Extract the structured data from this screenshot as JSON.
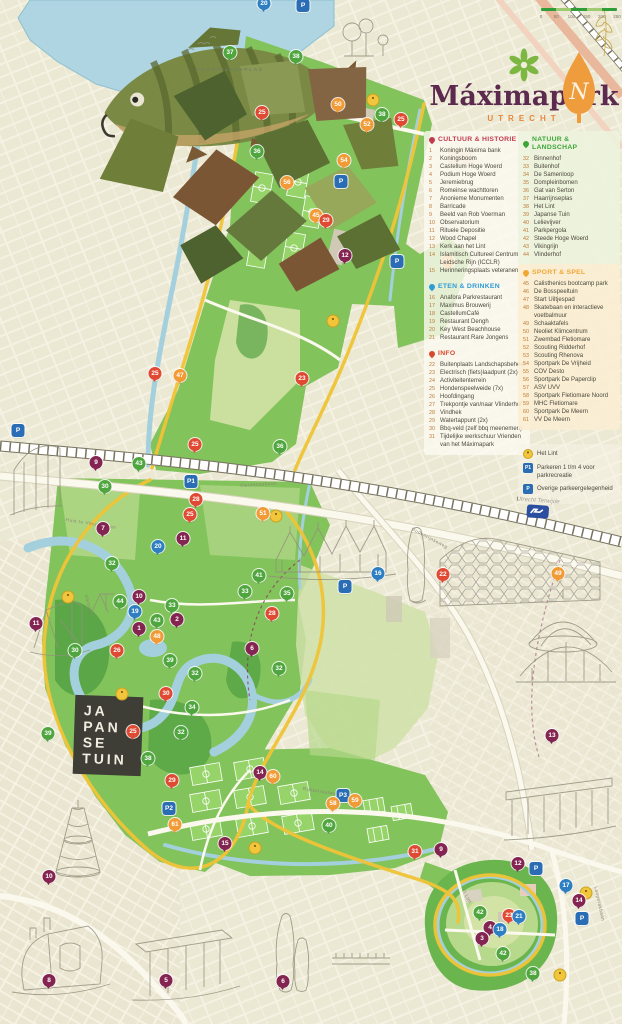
{
  "title": {
    "name": "Máximapark",
    "city": "UTRECHT"
  },
  "compass": {
    "letter": "N"
  },
  "scale_bar": {
    "ticks": [
      "0",
      "50",
      "100",
      "150",
      "200",
      "250"
    ]
  },
  "map_labels": {
    "lake": "HAARRIJNSEPLAS",
    "japanse_tuin": [
      "JA",
      "PAN",
      "SE",
      "TUIN"
    ],
    "station": "Utrecht Terwijde",
    "streets": [
      {
        "label": "Vleutensebaan",
        "x": 240,
        "y": 483,
        "r": -4
      },
      {
        "label": "Oudenrijnseweg",
        "x": 412,
        "y": 526,
        "r": 28
      },
      {
        "label": "Huis te Vleutenbaan",
        "x": 66,
        "y": 517,
        "r": 9
      },
      {
        "label": "Rijksstraatweg",
        "x": 303,
        "y": 786,
        "r": 9
      },
      {
        "label": "Langerakbaan",
        "x": 596,
        "y": 884,
        "r": 78
      },
      {
        "label": "Vikingrijn",
        "x": 86,
        "y": 592,
        "r": 75
      },
      {
        "label": "'t Lint",
        "x": 464,
        "y": 888,
        "r": 62
      }
    ]
  },
  "legend": {
    "sections": [
      {
        "id": "cultuur",
        "label": "CULTUUR & HISTORIE",
        "color": "#c23a4e",
        "items": [
          {
            "n": 1,
            "label": "Koningin Máxima bank"
          },
          {
            "n": 2,
            "label": "Koningsboom"
          },
          {
            "n": 3,
            "label": "Castellum Hoge Woerd"
          },
          {
            "n": 4,
            "label": "Podium Hoge Woerd"
          },
          {
            "n": 5,
            "label": "Jeremiebrug"
          },
          {
            "n": 6,
            "label": "Romeinse wachttoren"
          },
          {
            "n": 7,
            "label": "Anonieme Monumenten"
          },
          {
            "n": 8,
            "label": "Barricade"
          },
          {
            "n": 9,
            "label": "Beeld van Rob Voerman"
          },
          {
            "n": 10,
            "label": "Observatorium"
          },
          {
            "n": 11,
            "label": "Rituele Depositie"
          },
          {
            "n": 12,
            "label": "Wood Chapel"
          },
          {
            "n": 13,
            "label": "Kerk aan het Lint"
          },
          {
            "n": 14,
            "label": "Islamitisch Cultureel Centrum Leidsche Rijn (ICCLR)"
          },
          {
            "n": 15,
            "label": "Herinneringsplaats veteranen"
          }
        ]
      },
      {
        "id": "eten",
        "label": "ETEN & DRINKEN",
        "color": "#2e9bd6",
        "items": [
          {
            "n": 16,
            "label": "Anafora Parkrestaurant"
          },
          {
            "n": 17,
            "label": "Maximus Brouwerij"
          },
          {
            "n": 18,
            "label": "CastellumCafé"
          },
          {
            "n": 19,
            "label": "Restaurant Dengh"
          },
          {
            "n": 20,
            "label": "Key West Beachhouse"
          },
          {
            "n": 21,
            "label": "Restaurant Rare Jongens"
          }
        ]
      },
      {
        "id": "info",
        "label": "INFO",
        "color": "#d9472f",
        "items": [
          {
            "n": 22,
            "label": "Buitenplaats Landschapsbeheer"
          },
          {
            "n": 23,
            "label": "Electrisch (fiets)laadpunt (2x)"
          },
          {
            "n": 24,
            "label": "Activiteitenterrein"
          },
          {
            "n": 25,
            "label": "Hondenspeelweide (7x)"
          },
          {
            "n": 26,
            "label": "Hoofdingang"
          },
          {
            "n": 27,
            "label": "Trekpontje van/naar Vlinderhof"
          },
          {
            "n": 28,
            "label": "Vindhek"
          },
          {
            "n": 29,
            "label": "Watertappunt (2x)"
          },
          {
            "n": 30,
            "label": "Bbq-veld (zelf bbq meenemen)"
          },
          {
            "n": 31,
            "label": "Tijdelijke werkschuur Vrienden van het Máximapark"
          }
        ]
      },
      {
        "id": "natuur",
        "label": "NATUUR & LANDSCHAP",
        "color": "#3da639",
        "items": [
          {
            "n": 32,
            "label": "Binnenhof"
          },
          {
            "n": 33,
            "label": "Buitenhof"
          },
          {
            "n": 34,
            "label": "De Samenloop"
          },
          {
            "n": 35,
            "label": "Dompleinbomen"
          },
          {
            "n": 36,
            "label": "Gat van Serton"
          },
          {
            "n": 37,
            "label": "Haarrijnseplas"
          },
          {
            "n": 38,
            "label": "Het Lint"
          },
          {
            "n": 39,
            "label": "Japanse Tuin"
          },
          {
            "n": 40,
            "label": "Lelievijver"
          },
          {
            "n": 41,
            "label": "Parkpergola"
          },
          {
            "n": 42,
            "label": "Steede Hoge Woerd"
          },
          {
            "n": 43,
            "label": "Vikingrijn"
          },
          {
            "n": 44,
            "label": "Vlinderhof"
          }
        ]
      },
      {
        "id": "sport",
        "label": "SPORT & SPEL",
        "color": "#f2a632",
        "items": [
          {
            "n": 45,
            "label": "Calisthenics bootcamp park"
          },
          {
            "n": 46,
            "label": "De Bosspeeltuin"
          },
          {
            "n": 47,
            "label": "Start Uiltjespad"
          },
          {
            "n": 48,
            "label": "Skatebaan en interactieve voetbalmuur"
          },
          {
            "n": 49,
            "label": "Schaaktafels"
          },
          {
            "n": 50,
            "label": "Neoliet Klimcentrum"
          },
          {
            "n": 51,
            "label": "Zwembad Fletiomare"
          },
          {
            "n": 52,
            "label": "Scouting Ridderhof"
          },
          {
            "n": 53,
            "label": "Scouting Rhenova"
          },
          {
            "n": 54,
            "label": "Sportpark De Vrijheid"
          },
          {
            "n": 55,
            "label": "COV Desto"
          },
          {
            "n": 56,
            "label": "Sportpark De Paperclip"
          },
          {
            "n": 57,
            "label": "ASV UVV"
          },
          {
            "n": 58,
            "label": "Sportpark Fletiomare Noord"
          },
          {
            "n": 59,
            "label": "MHC Fletiomare"
          },
          {
            "n": 60,
            "label": "Sportpark De Meern"
          },
          {
            "n": 61,
            "label": "VV De Meern"
          }
        ]
      }
    ]
  },
  "footer_legend": {
    "items": [
      {
        "icon": "lint-lamp-icon",
        "label": "Het Lint"
      },
      {
        "icon": "parking-1-icon",
        "label": "Parkeren 1 t/m 4 voor parkrecreatie"
      },
      {
        "icon": "parking-icon",
        "label": "Overige parkeergelegenheid"
      }
    ]
  },
  "marker_colors": {
    "cultuur": "#832550",
    "eten": "#2e7fc1",
    "info": "#e04a33",
    "natuur": "#4fa53e",
    "sport": "#f29b36",
    "lint": "#f1c63c",
    "parking": "#2a6db5"
  },
  "theme": {
    "paper": "#efecd9",
    "park_green": "#83c35c",
    "water": "#aed5e1",
    "lint_yellow": "#f0c437",
    "title_maroon": "#5c2a4e",
    "accent_orange": "#e8873c"
  },
  "markers": [
    [
      "20",
      "e",
      264,
      10
    ],
    [
      "P",
      "P",
      303,
      12
    ],
    [
      "37",
      "n",
      230,
      59
    ],
    [
      "38",
      "n",
      296,
      63
    ],
    [
      "25",
      "i",
      262,
      119
    ],
    [
      "50",
      "s",
      338,
      111
    ],
    [
      "",
      "L",
      373,
      100
    ],
    [
      "38",
      "n",
      382,
      121
    ],
    [
      "25",
      "i",
      401,
      126
    ],
    [
      "52",
      "s",
      367,
      131
    ],
    [
      "36",
      "n",
      257,
      158
    ],
    [
      "54",
      "s",
      344,
      167
    ],
    [
      "56",
      "s",
      287,
      189
    ],
    [
      "P",
      "P",
      341,
      188
    ],
    [
      "45",
      "s",
      316,
      222
    ],
    [
      "29",
      "i",
      326,
      227
    ],
    [
      "53",
      "s",
      448,
      268
    ],
    [
      "12",
      "c",
      345,
      262
    ],
    [
      "P",
      "P",
      397,
      268
    ],
    [
      "",
      "L",
      333,
      321
    ],
    [
      "23",
      "i",
      302,
      385
    ],
    [
      "47",
      "s",
      180,
      382
    ],
    [
      "25",
      "i",
      155,
      380
    ],
    [
      "P",
      "P",
      18,
      437
    ],
    [
      "25",
      "i",
      195,
      451
    ],
    [
      "9",
      "c",
      96,
      469
    ],
    [
      "43",
      "n",
      139,
      470
    ],
    [
      "36",
      "n",
      280,
      453
    ],
    [
      "30",
      "n",
      105,
      493
    ],
    [
      "P1",
      "P",
      191,
      488
    ],
    [
      "28",
      "i",
      196,
      506
    ],
    [
      "25",
      "i",
      190,
      521
    ],
    [
      "7",
      "c",
      103,
      535
    ],
    [
      "",
      "L",
      276,
      516
    ],
    [
      "51",
      "s",
      263,
      520
    ],
    [
      "16",
      "e",
      378,
      580
    ],
    [
      "P",
      "P",
      345,
      593
    ],
    [
      "22",
      "i",
      443,
      581
    ],
    [
      "49",
      "s",
      558,
      580
    ],
    [
      "11",
      "c",
      183,
      545
    ],
    [
      "20",
      "e",
      158,
      553
    ],
    [
      "32",
      "n",
      112,
      570
    ],
    [
      "",
      "L",
      68,
      597
    ],
    [
      "44",
      "n",
      120,
      608
    ],
    [
      "10",
      "c",
      139,
      603
    ],
    [
      "19",
      "e",
      135,
      618
    ],
    [
      "33",
      "n",
      172,
      612
    ],
    [
      "2",
      "c",
      177,
      626
    ],
    [
      "43",
      "n",
      157,
      627
    ],
    [
      "1",
      "c",
      139,
      635
    ],
    [
      "48",
      "s",
      157,
      643
    ],
    [
      "26",
      "i",
      117,
      657
    ],
    [
      "30",
      "n",
      75,
      657
    ],
    [
      "39",
      "n",
      170,
      667
    ],
    [
      "32",
      "n",
      195,
      680
    ],
    [
      "41",
      "n",
      259,
      582
    ],
    [
      "33",
      "n",
      245,
      598
    ],
    [
      "35",
      "n",
      287,
      600
    ],
    [
      "28",
      "i",
      272,
      620
    ],
    [
      "6",
      "c",
      252,
      655
    ],
    [
      "32",
      "n",
      279,
      675
    ],
    [
      "13",
      "c",
      552,
      742
    ],
    [
      "39",
      "n",
      48,
      740
    ],
    [
      "",
      "L",
      122,
      694
    ],
    [
      "30",
      "i",
      166,
      700
    ],
    [
      "34",
      "n",
      192,
      714
    ],
    [
      "25",
      "i",
      133,
      738
    ],
    [
      "32",
      "n",
      181,
      739
    ],
    [
      "38",
      "n",
      148,
      765
    ],
    [
      "29",
      "i",
      172,
      787
    ],
    [
      "P2",
      "P",
      169,
      815
    ],
    [
      "61",
      "s",
      175,
      831
    ],
    [
      "15",
      "c",
      225,
      850
    ],
    [
      "",
      "L",
      255,
      848
    ],
    [
      "14",
      "c",
      260,
      779
    ],
    [
      "60",
      "s",
      273,
      783
    ],
    [
      "P3",
      "P",
      343,
      802
    ],
    [
      "58",
      "s",
      333,
      810
    ],
    [
      "59",
      "s",
      355,
      807
    ],
    [
      "40",
      "n",
      329,
      832
    ],
    [
      "31",
      "i",
      415,
      858
    ],
    [
      "9",
      "c",
      441,
      856
    ],
    [
      "12",
      "c",
      518,
      870
    ],
    [
      "P",
      "P",
      536,
      875
    ],
    [
      "17",
      "e",
      566,
      892
    ],
    [
      "",
      "L",
      586,
      893
    ],
    [
      "14",
      "c",
      579,
      907
    ],
    [
      "P",
      "P",
      582,
      925
    ],
    [
      "42",
      "n",
      480,
      919
    ],
    [
      "23",
      "i",
      509,
      922
    ],
    [
      "21",
      "e",
      519,
      923
    ],
    [
      "4",
      "c",
      490,
      934
    ],
    [
      "18",
      "e",
      500,
      936
    ],
    [
      "3",
      "c",
      482,
      945
    ],
    [
      "42",
      "n",
      503,
      960
    ],
    [
      "",
      "L",
      560,
      975
    ],
    [
      "38",
      "n",
      533,
      980
    ],
    [
      "10",
      "c",
      49,
      883
    ],
    [
      "8",
      "c",
      49,
      987
    ],
    [
      "5",
      "c",
      166,
      987
    ],
    [
      "6",
      "c",
      283,
      988
    ],
    [
      "11",
      "c",
      36,
      630
    ]
  ]
}
